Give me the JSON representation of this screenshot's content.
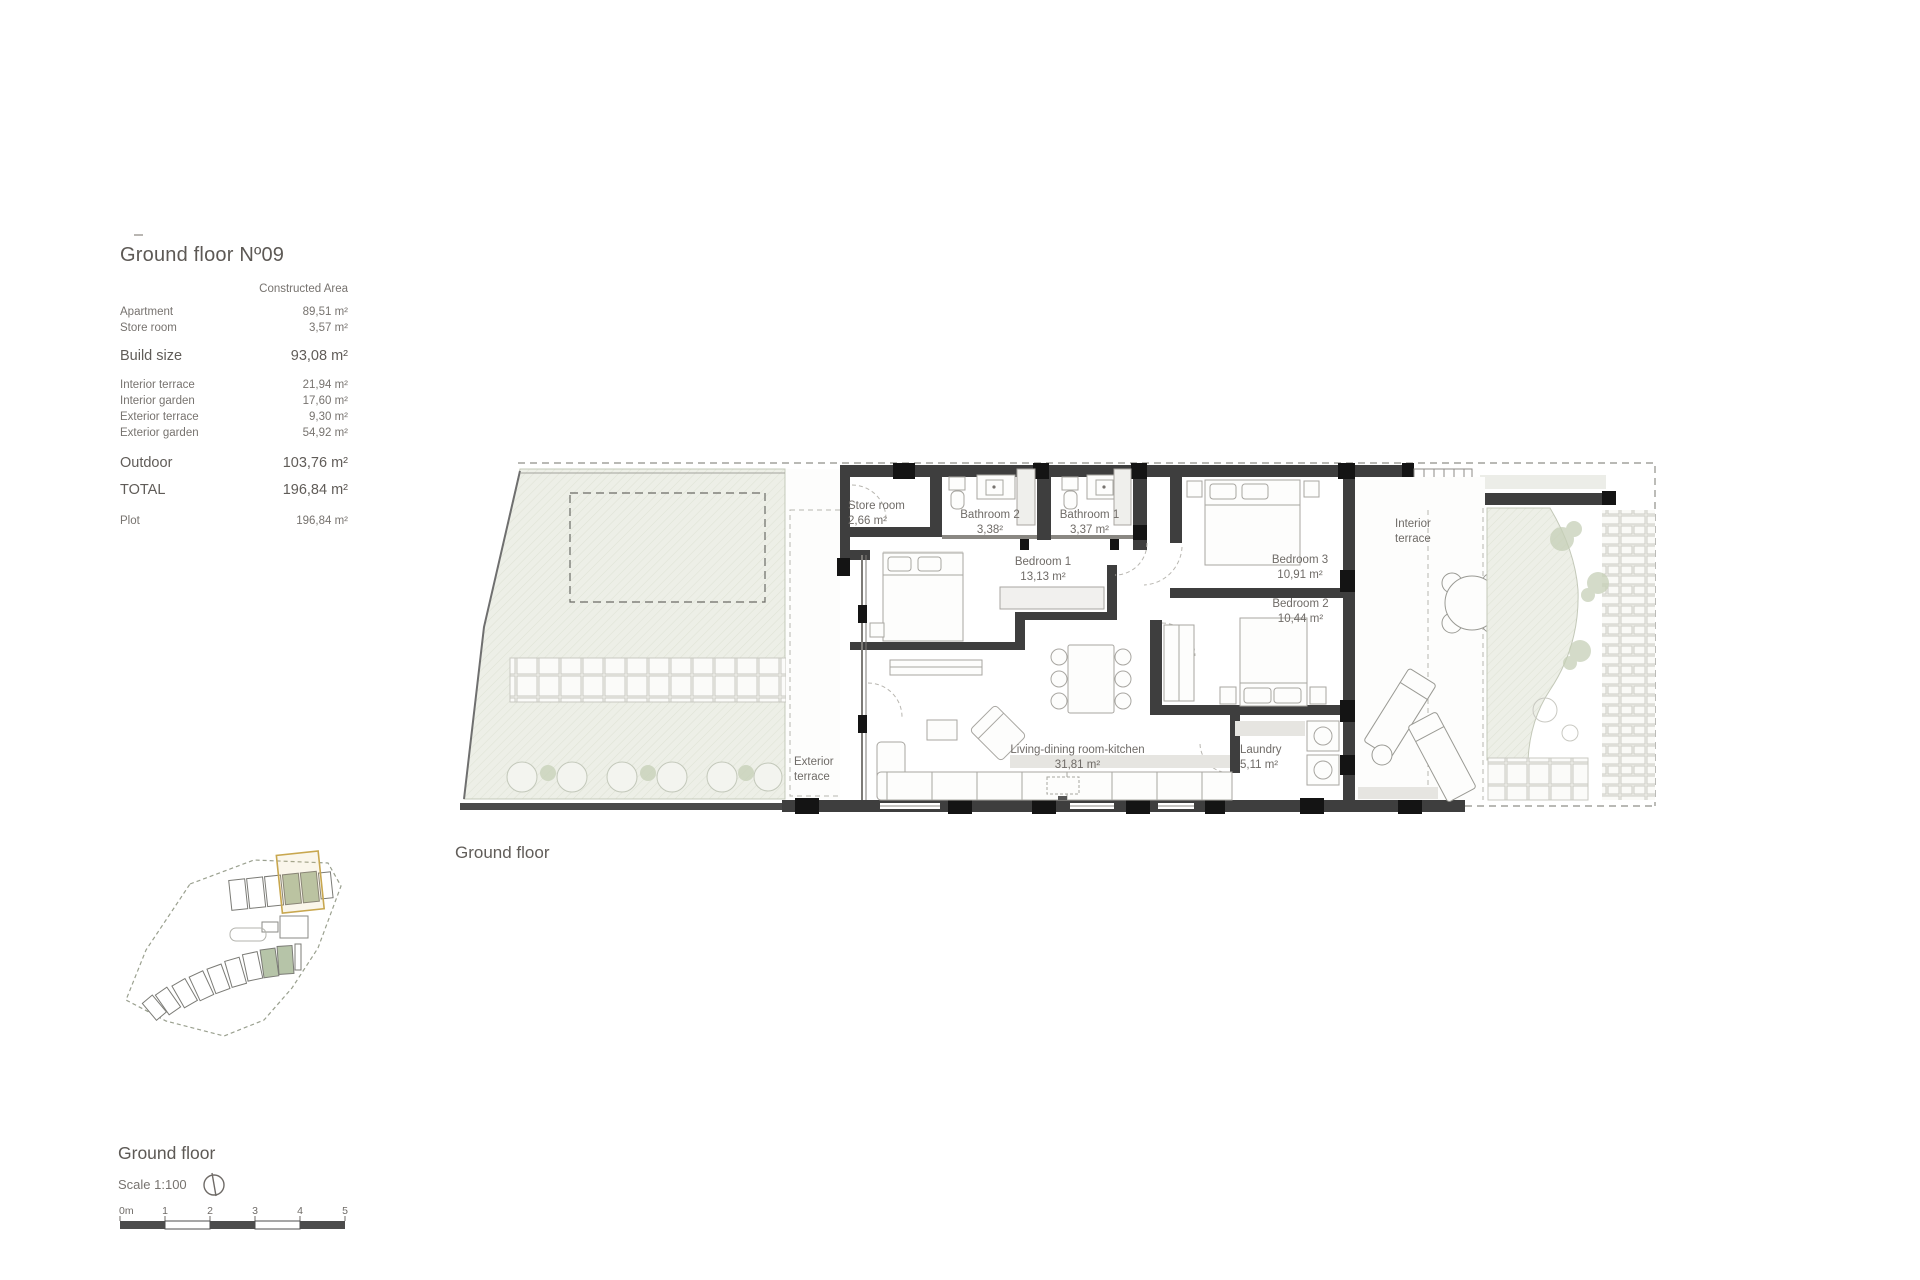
{
  "info_panel": {
    "title": "Ground floor Nº09",
    "column_header": "Constructed Area",
    "rows": [
      {
        "label": "Apartment",
        "value": "89,51 m²"
      },
      {
        "label": "Store room",
        "value": "3,57 m²"
      },
      {
        "label": "Build size",
        "value": "93,08 m²"
      },
      {
        "label": "Interior terrace",
        "value": "21,94 m²"
      },
      {
        "label": "Interior garden",
        "value": "17,60 m²"
      },
      {
        "label": "Exterior terrace",
        "value": "9,30 m²"
      },
      {
        "label": "Exterior garden",
        "value": "54,92 m²"
      },
      {
        "label": "Outdoor",
        "value": "103,76 m²"
      },
      {
        "label": "TOTAL",
        "value": "196,84 m²"
      },
      {
        "label": "Plot",
        "value": "196,84 m²"
      }
    ]
  },
  "plan": {
    "caption": "Ground floor",
    "rooms": {
      "store_room": {
        "name": "Store room",
        "area": "2,66 m²"
      },
      "bathroom_2": {
        "name": "Bathroom 2",
        "area": "3,38²"
      },
      "bathroom_1": {
        "name": "Bathroom 1",
        "area": "3,37 m²"
      },
      "bedroom_1": {
        "name": "Bedroom 1",
        "area": "13,13 m²"
      },
      "bedroom_3": {
        "name": "Bedroom 3",
        "area": "10,91 m²"
      },
      "bedroom_2": {
        "name": "Bedroom 2",
        "area": "10,44 m²"
      },
      "living": {
        "name": "Living-dining room-kitchen",
        "area": "31,81 m²"
      },
      "laundry": {
        "name": "Laundry",
        "area": "5,11 m²"
      },
      "interior_terrace": {
        "name": "Interior terrace"
      },
      "exterior_terrace": {
        "name": "Exterior terrace"
      }
    }
  },
  "footer": {
    "title": "Ground floor",
    "scale_label": "Scale 1:100",
    "scale_ticks": [
      "0m",
      "1",
      "2",
      "3",
      "4",
      "5"
    ]
  },
  "colors": {
    "wall": "#3e3e3e",
    "column_block": "#141414",
    "text": "#6f6b67",
    "garden_fill": "#edefe7",
    "highlighted_unit": "#b6c4a8",
    "selection_box": "#c8a74f"
  }
}
